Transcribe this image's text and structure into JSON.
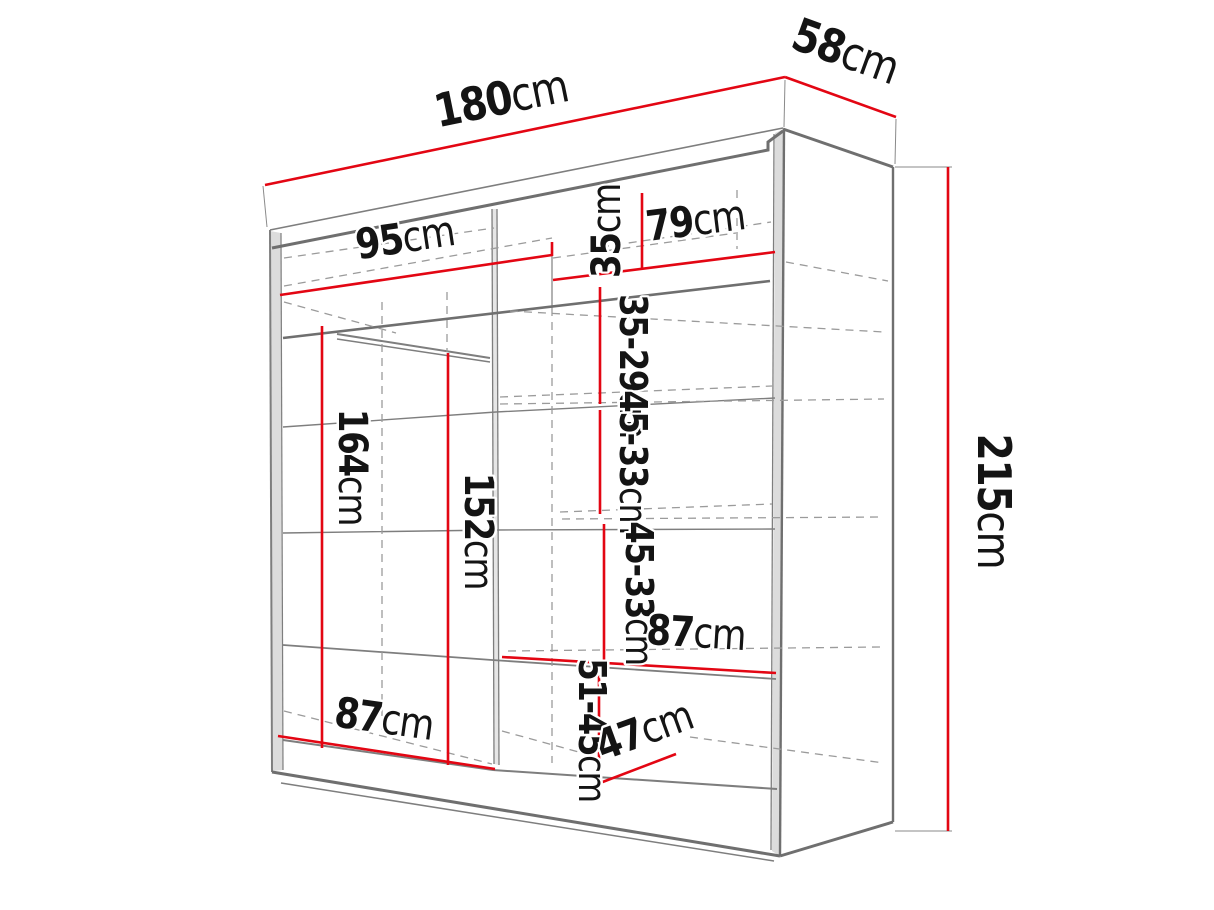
{
  "diagram": {
    "type": "furniture-dimension-drawing",
    "subject": "sliding-door wardrobe, open interior, perspective view",
    "unit": "cm"
  },
  "colors": {
    "dimension_line": "#e30613",
    "structure_line": "#7e7e7e",
    "hidden_edge": "#9b9b9b",
    "label_text": "#141414",
    "background": "#ffffff"
  },
  "dimensions": {
    "total_width": {
      "value": "180",
      "unit": "cm"
    },
    "total_depth": {
      "value": "58",
      "unit": "cm"
    },
    "total_height": {
      "value": "215",
      "unit": "cm"
    },
    "top_left_width": {
      "value": "95",
      "unit": "cm"
    },
    "top_right_width": {
      "value": "79",
      "unit": "cm"
    },
    "top_compartment_height": {
      "value": "35",
      "unit": "cm"
    },
    "right_gap_1": {
      "value": "35-29",
      "unit": "cm"
    },
    "right_gap_2": {
      "value": "45-33",
      "unit": "cm"
    },
    "right_gap_3": {
      "value": "45-33",
      "unit": "cm"
    },
    "right_gap_bottom": {
      "value": "51-45",
      "unit": "cm"
    },
    "left_section_height": {
      "value": "164",
      "unit": "cm"
    },
    "left_rail_height": {
      "value": "152",
      "unit": "cm"
    },
    "bottom_left_width": {
      "value": "87",
      "unit": "cm"
    },
    "right_shelf_width": {
      "value": "87",
      "unit": "cm"
    },
    "bottom_shelf_depth": {
      "value": "47",
      "unit": "cm"
    }
  }
}
